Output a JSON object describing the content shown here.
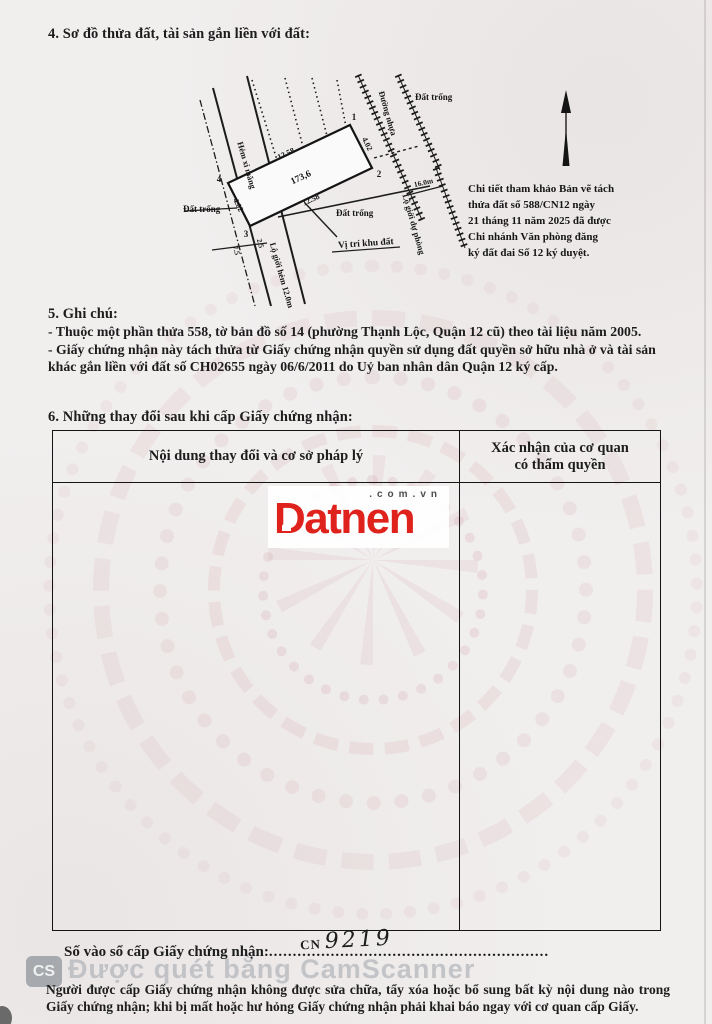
{
  "section4": {
    "title": "4. Sơ đồ thửa đất, tài sản gắn liền với đất:"
  },
  "diagram": {
    "plot": {
      "corner1": "1",
      "corner2": "2",
      "corner3": "3",
      "corner4": "4",
      "edge_top": "12.58",
      "edge_bottom": "12.58",
      "edge_left": "4.02",
      "edge_right": "4.02",
      "area": "173,6"
    },
    "labels": {
      "road_left": "Hẻm xi măng",
      "road_right": "Đường nhựa",
      "reserve_boundary": "Lộ giới dự phòng",
      "alley_boundary": "Lộ giới hẻm 12.0m",
      "empty_left": "Đất trống",
      "empty_top": "Đất trống",
      "empty_mid": "Đất trống",
      "location": "Vị trí khu đất",
      "width_16": "16.0m",
      "m75": "7.5",
      "m25": "2.5"
    },
    "note": [
      "Chi tiết tham khảo Bản vẽ tách",
      "thửa đất số  588/CN12  ngày",
      "21 tháng 11 năm 2025 đã được",
      "Chi nhánh Văn phòng đăng",
      "ký đất đai Số 12 ký duyệt."
    ]
  },
  "section5": {
    "title": "5. Ghi chú:",
    "items": [
      "- Thuộc một phần thửa 558, tờ bản đồ số 14 (phường Thạnh Lộc, Quận 12 cũ) theo tài liệu năm 2005.",
      "- Giấy chứng nhận này tách thửa từ Giấy chứng nhận quyền sử dụng đất quyền sở hữu nhà ở và tài sản khác gắn liền với đất số CH02655 ngày 06/6/2011 do Uỷ ban nhân dân Quận 12 ký cấp."
    ]
  },
  "section6": {
    "title": "6. Những thay đổi sau khi cấp Giấy chứng nhận:",
    "table": {
      "col1": "Nội dung thay đổi và cơ sở pháp lý",
      "col2_line1": "Xác nhận của cơ quan",
      "col2_line2": "có thẩm quyền"
    }
  },
  "watermark_logo": {
    "brand": "Datnen",
    "domain": ".com.vn",
    "brand_color": "#e0221d"
  },
  "footer": {
    "serial_label": "Số vào sổ cấp Giấy chứng nhận:",
    "serial_dots": "...........................................................",
    "serial_prefix": "CN",
    "serial_number": "9219",
    "notice": "Người được cấp Giấy chứng nhận không được sửa chữa, tẩy xóa hoặc bổ sung bất kỳ nội dung nào trong Giấy chứng nhận; khi bị mất hoặc hư hỏng Giấy chứng nhận phải khai báo ngay với cơ quan cấp Giấy.",
    "scanner_badge": "CS",
    "scanner_watermark": "Được quét bằng CamScanner",
    "scanner_gray": "#9ea4aa"
  }
}
